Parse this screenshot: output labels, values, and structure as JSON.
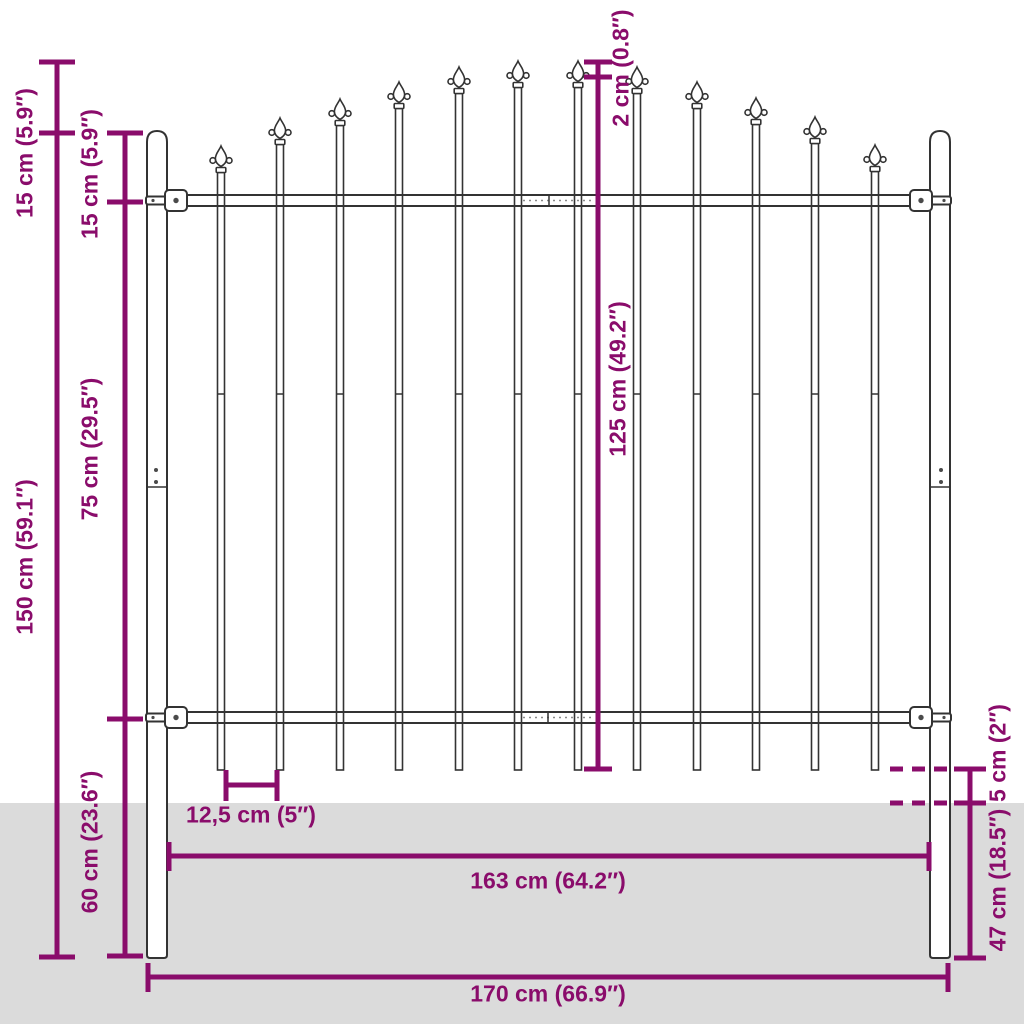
{
  "colors": {
    "accent": "#8A0C6B",
    "fence_line": "#333333",
    "ground": "#DBDBDB",
    "background": "#FFFFFF"
  },
  "dims": {
    "spear_above_post": "15 cm (5.9″)",
    "total_height": "150 cm (59.1″)",
    "post_above_rail": "15 cm (5.9″)",
    "rail_spacing": "75 cm (29.5″)",
    "lower_section": "60 cm (23.6″)",
    "spear_tip": "2 cm (0.8″)",
    "bar_length": "125 cm (49.2″)",
    "bar_spacing": "12,5 cm (5″)",
    "panel_width": "163 cm (64.2″)",
    "total_width": "170 cm (66.9″)",
    "above_ground": "5 cm (2″)",
    "below_ground": "47 cm (18.5″)"
  }
}
